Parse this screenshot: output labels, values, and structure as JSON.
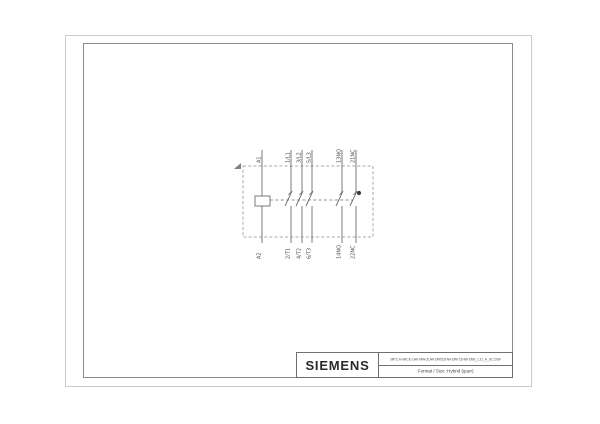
{
  "page": {
    "background": "#ffffff",
    "type": "technical-drawing-sheet"
  },
  "title_block": {
    "brand": "SIEMENS",
    "document_code": "3RT2.A-6RCE-1AK-MW-ZUW-ZRK5ZHW-ZRK7ZHW-ZME_L31_A_SC.DSF",
    "format_line": "Format / Size :Hybrid (quer)"
  },
  "diagram": {
    "kind": "contactor-circuit-diagram",
    "terminals": [
      {
        "top": "A1",
        "bottom": "A2",
        "type": "coil"
      },
      {
        "top": "1/L1",
        "bottom": "2/T1",
        "type": "no-contact"
      },
      {
        "top": "3/L2",
        "bottom": "4/T2",
        "type": "no-contact"
      },
      {
        "top": "5/L3",
        "bottom": "6/T3",
        "type": "no-contact"
      },
      {
        "top": "13NO",
        "bottom": "14NO",
        "type": "no-contact"
      },
      {
        "top": "21NC",
        "bottom": "22NC",
        "type": "nc-contact"
      }
    ],
    "colors": {
      "line": "#6d6d6d",
      "dashed_box": "#8f8f8f",
      "label": "#4a4a4a",
      "frame_outer": "#cbcbcb",
      "frame_inner": "#8a8a8a",
      "title_border": "#6f6f6f",
      "brand_text": "#2a2a2a"
    }
  }
}
